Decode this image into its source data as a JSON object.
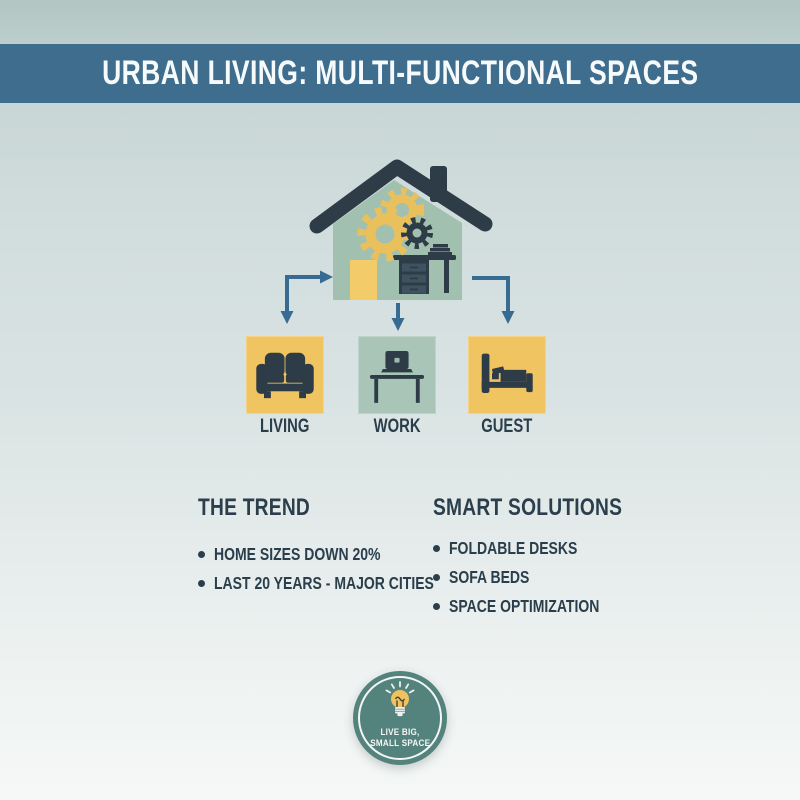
{
  "title": "URBAN LIVING: MULTI-FUNCTIONAL SPACES",
  "colors": {
    "header_bar": "#3e6d8e",
    "house_green": "#a2c0b0",
    "box_yellow": "#f0c460",
    "box_green": "#a8c5b7",
    "icon_dark": "#2d3c46",
    "gear_yellow": "#e9c05c",
    "arrow_blue": "#376b92",
    "badge_teal": "#54827c",
    "text_dark": "#2b3e4b"
  },
  "diagram": {
    "house_icon": "house-with-gears-and-desk",
    "rooms": [
      {
        "label": "LIVING",
        "icon": "sofa-icon",
        "box_color": "#f0c460"
      },
      {
        "label": "WORK",
        "icon": "desk-laptop-icon",
        "box_color": "#a8c5b7"
      },
      {
        "label": "GUEST",
        "icon": "bed-icon",
        "box_color": "#f0c460"
      }
    ]
  },
  "sections": [
    {
      "heading": "THE TREND",
      "bullets": [
        "HOME SIZES DOWN 20%",
        "LAST 20 YEARS - MAJOR CITIES"
      ]
    },
    {
      "heading": "SMART SOLUTIONS",
      "bullets": [
        "FOLDABLE DESKS",
        "SOFA BEDS",
        "SPACE OPTIMIZATION"
      ]
    }
  ],
  "badge": {
    "icon": "lightbulb-icon",
    "line1": "LIVE BIG,",
    "line2": "SMALL SPACE"
  }
}
